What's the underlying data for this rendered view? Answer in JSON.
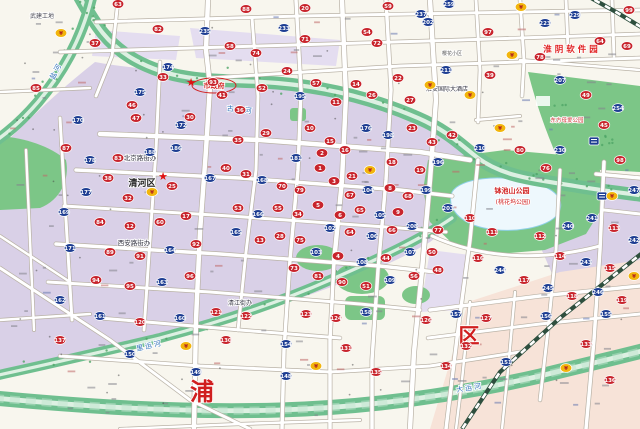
{
  "map": {
    "name": "huaian-city-street-map",
    "palette": {
      "base": "#f8f6ee",
      "urban": "#d9d0e7",
      "urban_light": "#e4ddf0",
      "pink_zone": "#f7e3d8",
      "water": "#6fbf8f",
      "water_center": "#ddf0e2",
      "park": "#7cc687",
      "park_dark": "#4fa566",
      "lake": "#eef8fd",
      "road_casing": "#b9b2a6",
      "road_fill": "#ffffff",
      "rail_dark": "#2e4f3e",
      "marker_red": "#c8242c",
      "marker_blue": "#1d3d92",
      "marker_yellow": "#f2b50c",
      "label_red": "#d01f1f",
      "label_blue": "#2d6fb8",
      "star_red": "#e01111"
    },
    "district_labels": [
      {
        "text": "清河区",
        "x": 142,
        "y": 186,
        "size": 9,
        "color": "#222222",
        "bold": true
      }
    ],
    "big_chars": [
      {
        "text": "浦",
        "x": 202,
        "y": 400,
        "size": 24
      },
      {
        "text": "区",
        "x": 469,
        "y": 343,
        "size": 21
      }
    ],
    "poi_labels": [
      {
        "text": "武建工地",
        "x": 42,
        "y": 18,
        "size": 6,
        "color": "#4a4a55"
      },
      {
        "text": "北京路街办",
        "x": 140,
        "y": 160,
        "size": 6.5,
        "color": "#333340"
      },
      {
        "text": "西安路街办",
        "x": 134,
        "y": 245,
        "size": 6.5,
        "color": "#333340"
      },
      {
        "text": "清江街办",
        "x": 240,
        "y": 305,
        "size": 6,
        "color": "#333340"
      },
      {
        "text": "市政府",
        "x": 214,
        "y": 88,
        "size": 7,
        "color": "#d01f1f",
        "bold": true,
        "ellipse": true
      },
      {
        "text": "淮阴软件园",
        "x": 572,
        "y": 52,
        "size": 8.5,
        "color": "#e02222",
        "bold": true,
        "spacing": 3
      },
      {
        "text": "东方母爱公园",
        "x": 567,
        "y": 122,
        "size": 5.5,
        "color": "#cc3333"
      },
      {
        "text": "淮安国际大酒店",
        "x": 447,
        "y": 91,
        "size": 6,
        "color": "#333340"
      },
      {
        "text": "钵池山公园",
        "x": 512,
        "y": 193,
        "size": 7,
        "color": "#d01f1f",
        "bold": true
      },
      {
        "text": "(桃花坞公园)",
        "x": 513,
        "y": 204,
        "size": 6,
        "color": "#d01f1f"
      },
      {
        "text": "樱花小区",
        "x": 452,
        "y": 55,
        "size": 5,
        "color": "#555555"
      }
    ],
    "water_labels": [
      {
        "text": "古黄河",
        "x": 240,
        "y": 112,
        "angle": 6
      },
      {
        "text": "盐河",
        "x": 58,
        "y": 72,
        "angle": -62
      },
      {
        "text": "里运河",
        "x": 150,
        "y": 348,
        "angle": -13
      },
      {
        "text": "大运河",
        "x": 470,
        "y": 390,
        "angle": -9
      }
    ],
    "stars": [
      [
        191,
        83
      ],
      [
        163,
        177
      ]
    ],
    "signs": [
      {
        "x": 594,
        "y": 141
      },
      {
        "x": 602,
        "y": 196
      }
    ],
    "markers": [
      [
        118,
        4,
        "r",
        "63"
      ],
      [
        246,
        9,
        "r",
        "88"
      ],
      [
        305,
        8,
        "r",
        "20"
      ],
      [
        388,
        6,
        "r",
        "59"
      ],
      [
        449,
        4,
        "b",
        "259"
      ],
      [
        521,
        7,
        "y",
        ""
      ],
      [
        575,
        15,
        "b",
        "229"
      ],
      [
        629,
        10,
        "r",
        "99"
      ],
      [
        205,
        31,
        "b",
        "235"
      ],
      [
        284,
        28,
        "b",
        "233"
      ],
      [
        305,
        39,
        "r",
        "71"
      ],
      [
        367,
        32,
        "r",
        "54"
      ],
      [
        377,
        43,
        "r",
        "72"
      ],
      [
        421,
        14,
        "b",
        "237"
      ],
      [
        428,
        22,
        "b",
        "202"
      ],
      [
        61,
        33,
        "y",
        ""
      ],
      [
        95,
        43,
        "r",
        "37"
      ],
      [
        158,
        29,
        "r",
        "82"
      ],
      [
        488,
        32,
        "r",
        "97"
      ],
      [
        545,
        23,
        "b",
        "223"
      ],
      [
        600,
        41,
        "r",
        "64"
      ],
      [
        627,
        46,
        "r",
        "69"
      ],
      [
        230,
        46,
        "r",
        "58"
      ],
      [
        256,
        53,
        "r",
        "74"
      ],
      [
        512,
        55,
        "y",
        ""
      ],
      [
        540,
        57,
        "r",
        "78"
      ],
      [
        168,
        67,
        "b",
        "174"
      ],
      [
        163,
        77,
        "r",
        "33"
      ],
      [
        140,
        92,
        "b",
        "175"
      ],
      [
        78,
        120,
        "b",
        "170"
      ],
      [
        132,
        105,
        "r",
        "46"
      ],
      [
        136,
        118,
        "r",
        "47"
      ],
      [
        190,
        117,
        "r",
        "30"
      ],
      [
        181,
        125,
        "b",
        "172"
      ],
      [
        213,
        82,
        "r",
        "93"
      ],
      [
        222,
        95,
        "r",
        "41"
      ],
      [
        240,
        110,
        "r",
        "36"
      ],
      [
        262,
        88,
        "r",
        "52"
      ],
      [
        287,
        71,
        "r",
        "24"
      ],
      [
        300,
        96,
        "b",
        "195"
      ],
      [
        316,
        83,
        "r",
        "57"
      ],
      [
        336,
        102,
        "r",
        "11"
      ],
      [
        356,
        84,
        "r",
        "14"
      ],
      [
        372,
        95,
        "r",
        "26"
      ],
      [
        398,
        78,
        "r",
        "22"
      ],
      [
        410,
        100,
        "r",
        "27"
      ],
      [
        430,
        85,
        "y",
        ""
      ],
      [
        446,
        70,
        "b",
        "211"
      ],
      [
        470,
        95,
        "y",
        ""
      ],
      [
        490,
        75,
        "r",
        "39"
      ],
      [
        560,
        80,
        "b",
        "207"
      ],
      [
        586,
        95,
        "r",
        "49"
      ],
      [
        618,
        108,
        "b",
        "254"
      ],
      [
        604,
        125,
        "r",
        "45"
      ],
      [
        36,
        88,
        "r",
        "85"
      ],
      [
        238,
        140,
        "r",
        "35"
      ],
      [
        266,
        133,
        "r",
        "29"
      ],
      [
        310,
        128,
        "r",
        "10"
      ],
      [
        330,
        141,
        "r",
        "15"
      ],
      [
        296,
        158,
        "b",
        "181"
      ],
      [
        322,
        153,
        "r",
        "2"
      ],
      [
        345,
        150,
        "r",
        "16"
      ],
      [
        366,
        128,
        "b",
        "176"
      ],
      [
        388,
        135,
        "b",
        "198"
      ],
      [
        412,
        128,
        "r",
        "23"
      ],
      [
        432,
        142,
        "r",
        "43"
      ],
      [
        452,
        135,
        "r",
        "42"
      ],
      [
        320,
        168,
        "r",
        "1"
      ],
      [
        334,
        181,
        "r",
        "3"
      ],
      [
        352,
        176,
        "r",
        "21"
      ],
      [
        370,
        170,
        "y",
        ""
      ],
      [
        392,
        162,
        "r",
        "18"
      ],
      [
        420,
        170,
        "r",
        "19"
      ],
      [
        438,
        162,
        "b",
        "196"
      ],
      [
        300,
        190,
        "r",
        "79"
      ],
      [
        282,
        186,
        "r",
        "70"
      ],
      [
        262,
        180,
        "b",
        "168"
      ],
      [
        246,
        174,
        "r",
        "31"
      ],
      [
        226,
        168,
        "r",
        "40"
      ],
      [
        210,
        178,
        "b",
        "167"
      ],
      [
        350,
        195,
        "r",
        "67"
      ],
      [
        368,
        190,
        "b",
        "104"
      ],
      [
        390,
        188,
        "r",
        "8"
      ],
      [
        408,
        196,
        "r",
        "68"
      ],
      [
        426,
        190,
        "b",
        "199"
      ],
      [
        318,
        205,
        "r",
        "5"
      ],
      [
        298,
        214,
        "r",
        "34"
      ],
      [
        278,
        208,
        "r",
        "55"
      ],
      [
        258,
        214,
        "b",
        "166"
      ],
      [
        238,
        208,
        "r",
        "53"
      ],
      [
        340,
        215,
        "r",
        "6"
      ],
      [
        360,
        210,
        "r",
        "65"
      ],
      [
        380,
        215,
        "b",
        "105"
      ],
      [
        398,
        212,
        "r",
        "9"
      ],
      [
        330,
        228,
        "b",
        "102"
      ],
      [
        350,
        232,
        "r",
        "64"
      ],
      [
        372,
        236,
        "b",
        "106"
      ],
      [
        392,
        230,
        "r",
        "66"
      ],
      [
        412,
        226,
        "b",
        "208"
      ],
      [
        438,
        230,
        "r",
        "77"
      ],
      [
        300,
        240,
        "r",
        "75"
      ],
      [
        280,
        236,
        "r",
        "28"
      ],
      [
        260,
        240,
        "r",
        "13"
      ],
      [
        236,
        232,
        "b",
        "165"
      ],
      [
        316,
        252,
        "b",
        "103"
      ],
      [
        338,
        256,
        "r",
        "4"
      ],
      [
        362,
        262,
        "b",
        "108"
      ],
      [
        386,
        258,
        "r",
        "44"
      ],
      [
        410,
        252,
        "b",
        "107"
      ],
      [
        432,
        252,
        "r",
        "50"
      ],
      [
        294,
        268,
        "r",
        "73"
      ],
      [
        318,
        276,
        "r",
        "81"
      ],
      [
        342,
        282,
        "r",
        "90"
      ],
      [
        366,
        286,
        "r",
        "51"
      ],
      [
        390,
        280,
        "b",
        "109"
      ],
      [
        414,
        276,
        "r",
        "56"
      ],
      [
        438,
        270,
        "r",
        "48"
      ],
      [
        66,
        148,
        "r",
        "87"
      ],
      [
        90,
        160,
        "b",
        "178"
      ],
      [
        118,
        158,
        "r",
        "83"
      ],
      [
        150,
        152,
        "b",
        "188"
      ],
      [
        176,
        148,
        "b",
        "186"
      ],
      [
        108,
        178,
        "r",
        "38"
      ],
      [
        86,
        192,
        "b",
        "177"
      ],
      [
        128,
        198,
        "r",
        "32"
      ],
      [
        152,
        192,
        "y",
        ""
      ],
      [
        172,
        186,
        "r",
        "25"
      ],
      [
        64,
        212,
        "b",
        "169"
      ],
      [
        100,
        222,
        "r",
        "84"
      ],
      [
        130,
        226,
        "r",
        "12"
      ],
      [
        160,
        222,
        "r",
        "60"
      ],
      [
        186,
        216,
        "r",
        "17"
      ],
      [
        70,
        248,
        "b",
        "171"
      ],
      [
        110,
        252,
        "r",
        "89"
      ],
      [
        140,
        256,
        "r",
        "91"
      ],
      [
        170,
        250,
        "b",
        "164"
      ],
      [
        196,
        244,
        "r",
        "92"
      ],
      [
        96,
        280,
        "r",
        "94"
      ],
      [
        130,
        286,
        "r",
        "95"
      ],
      [
        162,
        282,
        "b",
        "163"
      ],
      [
        190,
        276,
        "r",
        "96"
      ],
      [
        60,
        300,
        "b",
        "162"
      ],
      [
        546,
        168,
        "r",
        "76"
      ],
      [
        500,
        128,
        "y",
        ""
      ],
      [
        480,
        148,
        "b",
        "210"
      ],
      [
        520,
        150,
        "r",
        "80"
      ],
      [
        560,
        150,
        "b",
        "230"
      ],
      [
        620,
        160,
        "r",
        "98"
      ],
      [
        448,
        208,
        "b",
        "203"
      ],
      [
        470,
        218,
        "r",
        "110"
      ],
      [
        492,
        232,
        "r",
        "111"
      ],
      [
        540,
        236,
        "r",
        "112"
      ],
      [
        568,
        226,
        "b",
        "240"
      ],
      [
        592,
        218,
        "b",
        "241"
      ],
      [
        614,
        228,
        "r",
        "113"
      ],
      [
        634,
        240,
        "b",
        "242"
      ],
      [
        560,
        256,
        "r",
        "114"
      ],
      [
        586,
        262,
        "b",
        "243"
      ],
      [
        610,
        268,
        "r",
        "115"
      ],
      [
        634,
        276,
        "y",
        ""
      ],
      [
        478,
        258,
        "r",
        "116"
      ],
      [
        500,
        270,
        "b",
        "244"
      ],
      [
        524,
        280,
        "r",
        "117"
      ],
      [
        548,
        288,
        "b",
        "245"
      ],
      [
        572,
        296,
        "r",
        "118"
      ],
      [
        598,
        292,
        "b",
        "246"
      ],
      [
        622,
        300,
        "r",
        "119"
      ],
      [
        634,
        190,
        "b",
        "247"
      ],
      [
        612,
        196,
        "y",
        ""
      ],
      [
        100,
        316,
        "b",
        "161"
      ],
      [
        140,
        322,
        "r",
        "120"
      ],
      [
        180,
        318,
        "b",
        "160"
      ],
      [
        216,
        312,
        "r",
        "121"
      ],
      [
        246,
        316,
        "r",
        "122"
      ],
      [
        306,
        314,
        "r",
        "123"
      ],
      [
        336,
        318,
        "r",
        "124"
      ],
      [
        366,
        312,
        "b",
        "158"
      ],
      [
        426,
        320,
        "r",
        "126"
      ],
      [
        456,
        314,
        "b",
        "157"
      ],
      [
        486,
        318,
        "r",
        "127"
      ],
      [
        546,
        316,
        "b",
        "156"
      ],
      [
        606,
        314,
        "b",
        "155"
      ],
      [
        226,
        340,
        "r",
        "130"
      ],
      [
        286,
        344,
        "b",
        "154"
      ],
      [
        346,
        348,
        "r",
        "131"
      ],
      [
        466,
        346,
        "r",
        "132"
      ],
      [
        586,
        344,
        "r",
        "133"
      ],
      [
        186,
        346,
        "y",
        ""
      ],
      [
        316,
        366,
        "y",
        ""
      ],
      [
        446,
        366,
        "r",
        "134"
      ],
      [
        506,
        362,
        "b",
        "151"
      ],
      [
        130,
        354,
        "b",
        "150"
      ],
      [
        566,
        368,
        "y",
        ""
      ],
      [
        196,
        372,
        "b",
        "149"
      ],
      [
        286,
        376,
        "b",
        "148"
      ],
      [
        376,
        372,
        "r",
        "135"
      ],
      [
        610,
        380,
        "r",
        "136"
      ],
      [
        60,
        340,
        "r",
        "137"
      ]
    ]
  }
}
